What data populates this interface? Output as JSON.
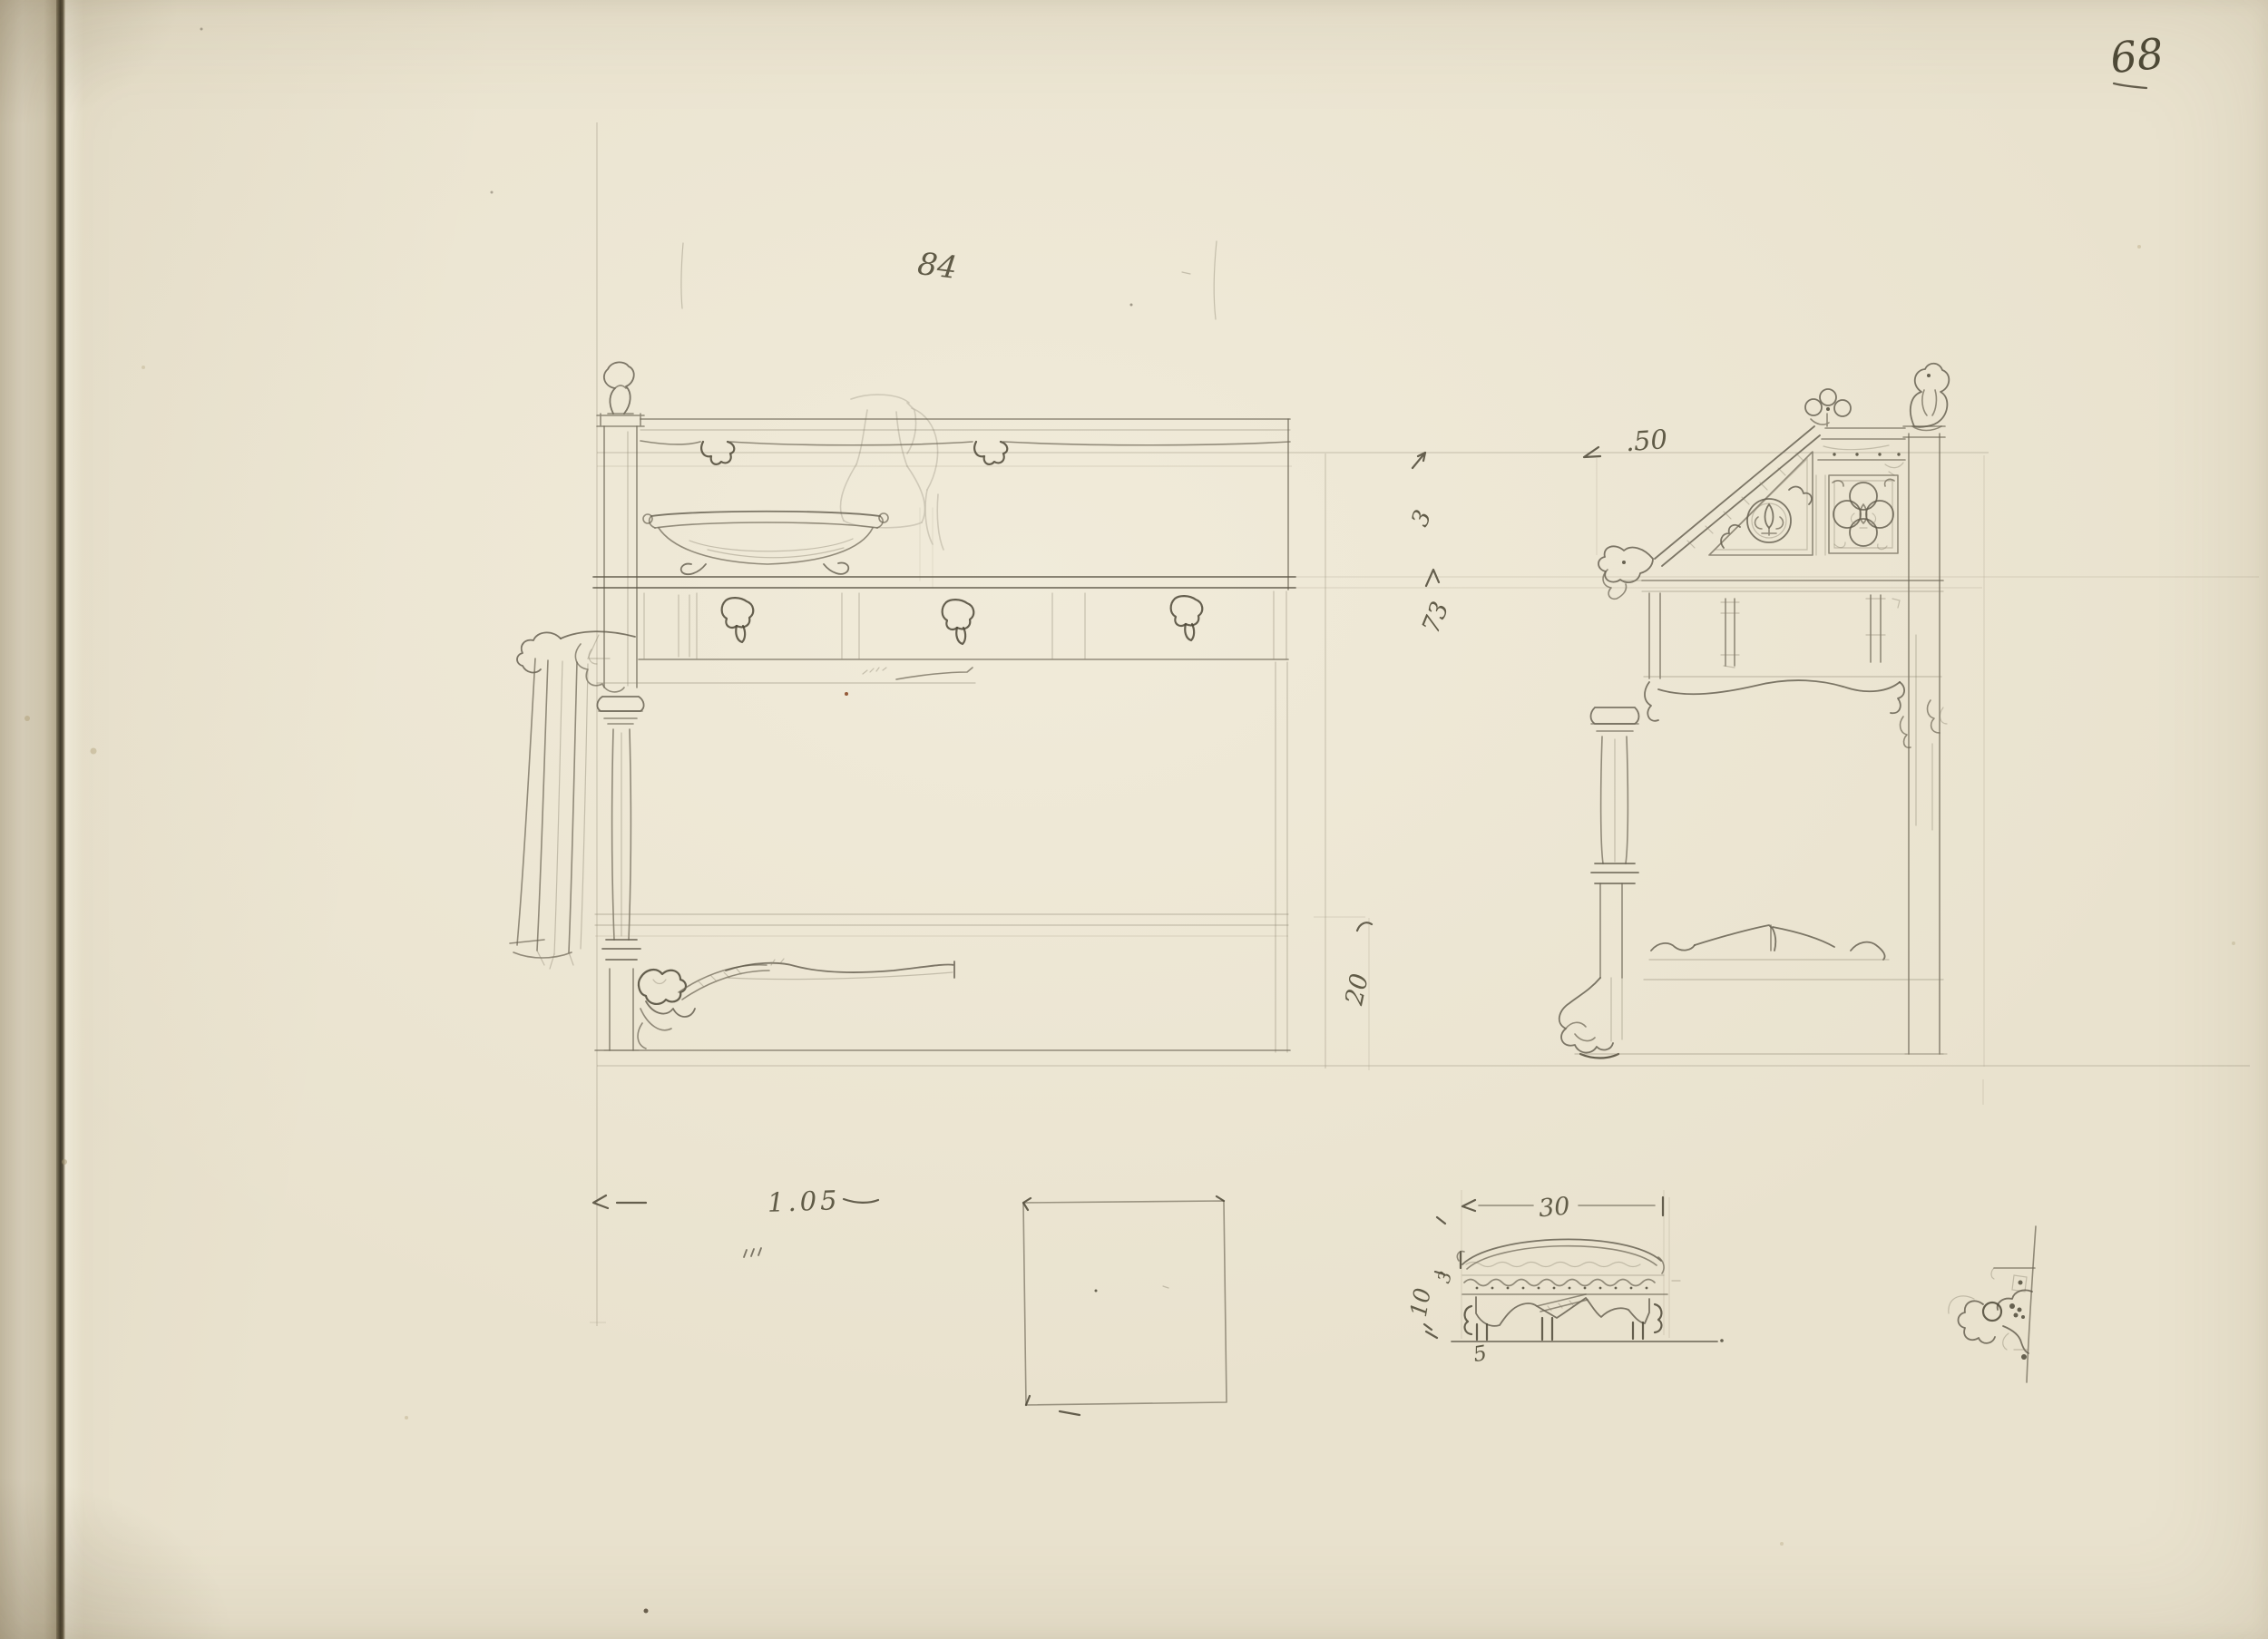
{
  "page": {
    "number": "68",
    "paper_color": "#e9e2ce",
    "binding_edge_color": "#d6cdb8",
    "crease_color": "#3e382a",
    "pencil_color": "#6e6756",
    "handwriting_color": "#55503c"
  },
  "annotations": {
    "page_number": "68",
    "figure_number": "84",
    "dim_top_depth": ".50",
    "dim_back_upper": "3",
    "dim_back_height": "73",
    "dim_shelf_height": "20",
    "dim_overall_width": "1.05",
    "dim_section_width": "30",
    "dim_section_height": "10",
    "dim_section_moulding": "3",
    "dim_section_base": "5"
  }
}
